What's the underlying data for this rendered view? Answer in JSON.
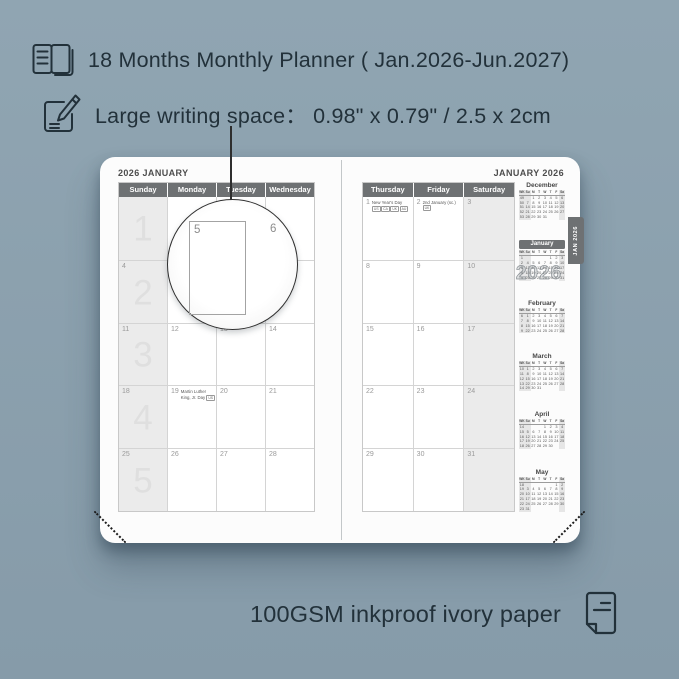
{
  "colors": {
    "background_top": "#90a5b2",
    "background_bottom": "#869ba9",
    "ink_text": "#22313a",
    "header_bar": "#6e7173",
    "page": "#fcfcfc",
    "weekend_shade": "#ebebeb"
  },
  "features": [
    {
      "icon": "open-book-icon",
      "text": "18 Months Monthly Planner ( Jan.2026-Jun.2027)"
    },
    {
      "icon": "pencil-note-icon",
      "text": "Large writing space：  0.98\" x 0.79\" / 2.5 x 2cm"
    }
  ],
  "bottom_feature": {
    "icon": "paper-icon",
    "text": "100GSM inkproof ivory paper"
  },
  "planner": {
    "left_page": {
      "title": "2026 JANUARY",
      "day_headers": [
        "Sunday",
        "Monday",
        "Tuesday",
        "Wednesday"
      ],
      "weekend_column_index": 0,
      "rows": [
        {
          "week": "1",
          "cells": [
            {
              "date": ""
            },
            {
              "date": ""
            },
            {
              "date": ""
            },
            {
              "date": ""
            }
          ]
        },
        {
          "week": "2",
          "cells": [
            {
              "date": "4"
            },
            {
              "date": "5"
            },
            {
              "date": "6"
            },
            {
              "date": "7"
            }
          ]
        },
        {
          "week": "3",
          "cells": [
            {
              "date": "11"
            },
            {
              "date": "12"
            },
            {
              "date": "13"
            },
            {
              "date": "14"
            }
          ]
        },
        {
          "week": "4",
          "cells": [
            {
              "date": "18"
            },
            {
              "date": "19",
              "holiday": "Martin Luther King, Jr. Day",
              "badges": [
                "US"
              ],
              "badges_position": "inline"
            },
            {
              "date": "20"
            },
            {
              "date": "21"
            }
          ]
        },
        {
          "week": "5",
          "cells": [
            {
              "date": "25"
            },
            {
              "date": "26"
            },
            {
              "date": "27"
            },
            {
              "date": "28"
            }
          ]
        }
      ]
    },
    "right_page": {
      "title": "JANUARY 2026",
      "day_headers": [
        "Thursday",
        "Friday",
        "Saturday"
      ],
      "weekend_column_index": 2,
      "rows": [
        {
          "cells": [
            {
              "date": "1",
              "holiday": "New Year's Day",
              "badges": [
                "US",
                "CA",
                "UK",
                "AU"
              ],
              "badges_position": "below"
            },
            {
              "date": "2",
              "holiday": "2nd January (sc.)",
              "badges": [
                "UK"
              ],
              "badges_position": "inline"
            },
            {
              "date": "3"
            }
          ]
        },
        {
          "cells": [
            {
              "date": "8"
            },
            {
              "date": "9"
            },
            {
              "date": "10"
            }
          ]
        },
        {
          "cells": [
            {
              "date": "15"
            },
            {
              "date": "16"
            },
            {
              "date": "17"
            }
          ]
        },
        {
          "cells": [
            {
              "date": "22"
            },
            {
              "date": "23"
            },
            {
              "date": "24"
            }
          ]
        },
        {
          "cells": [
            {
              "date": "29"
            },
            {
              "date": "30"
            },
            {
              "date": "31"
            }
          ]
        }
      ],
      "tab": "JAN 2026",
      "watermark": "2026",
      "mini_header": [
        "WK",
        "Su",
        "M",
        "T",
        "W",
        "T",
        "F",
        "Sa"
      ],
      "mini_calendars": [
        {
          "month": "December",
          "highlight": false,
          "weeks": [
            [
              "49",
              "",
              "1",
              "2",
              "3",
              "4",
              "5",
              "6"
            ],
            [
              "50",
              "7",
              "8",
              "9",
              "10",
              "11",
              "12",
              "13"
            ],
            [
              "51",
              "14",
              "15",
              "16",
              "17",
              "18",
              "19",
              "20"
            ],
            [
              "52",
              "21",
              "22",
              "23",
              "24",
              "25",
              "26",
              "27"
            ],
            [
              "53",
              "28",
              "29",
              "30",
              "31",
              "",
              "",
              ""
            ]
          ]
        },
        {
          "month": "January",
          "highlight": true,
          "weeks": [
            [
              "1",
              "",
              "",
              "",
              "",
              "1",
              "2",
              "3"
            ],
            [
              "2",
              "4",
              "5",
              "6",
              "7",
              "8",
              "9",
              "10"
            ],
            [
              "3",
              "11",
              "12",
              "13",
              "14",
              "15",
              "16",
              "17"
            ],
            [
              "4",
              "18",
              "19",
              "20",
              "21",
              "22",
              "23",
              "24"
            ],
            [
              "5",
              "25",
              "26",
              "27",
              "28",
              "29",
              "30",
              "31"
            ]
          ]
        },
        {
          "month": "February",
          "highlight": false,
          "weeks": [
            [
              "6",
              "1",
              "2",
              "3",
              "4",
              "5",
              "6",
              "7"
            ],
            [
              "7",
              "8",
              "9",
              "10",
              "11",
              "12",
              "13",
              "14"
            ],
            [
              "8",
              "15",
              "16",
              "17",
              "18",
              "19",
              "20",
              "21"
            ],
            [
              "9",
              "22",
              "23",
              "24",
              "25",
              "26",
              "27",
              "28"
            ]
          ]
        },
        {
          "month": "March",
          "highlight": false,
          "weeks": [
            [
              "10",
              "1",
              "2",
              "3",
              "4",
              "5",
              "6",
              "7"
            ],
            [
              "11",
              "8",
              "9",
              "10",
              "11",
              "12",
              "13",
              "14"
            ],
            [
              "12",
              "15",
              "16",
              "17",
              "18",
              "19",
              "20",
              "21"
            ],
            [
              "13",
              "22",
              "23",
              "24",
              "25",
              "26",
              "27",
              "28"
            ],
            [
              "14",
              "29",
              "30",
              "31",
              "",
              "",
              "",
              ""
            ]
          ]
        },
        {
          "month": "April",
          "highlight": false,
          "weeks": [
            [
              "14",
              "",
              "",
              "",
              "1",
              "2",
              "3",
              "4"
            ],
            [
              "15",
              "5",
              "6",
              "7",
              "8",
              "9",
              "10",
              "11"
            ],
            [
              "16",
              "12",
              "13",
              "14",
              "15",
              "16",
              "17",
              "18"
            ],
            [
              "17",
              "19",
              "20",
              "21",
              "22",
              "23",
              "24",
              "25"
            ],
            [
              "18",
              "26",
              "27",
              "28",
              "29",
              "30",
              "",
              ""
            ]
          ]
        },
        {
          "month": "May",
          "highlight": false,
          "weeks": [
            [
              "18",
              "",
              "",
              "",
              "",
              "",
              "1",
              "2"
            ],
            [
              "19",
              "3",
              "4",
              "5",
              "6",
              "7",
              "8",
              "9"
            ],
            [
              "20",
              "10",
              "11",
              "12",
              "13",
              "14",
              "15",
              "16"
            ],
            [
              "21",
              "17",
              "18",
              "19",
              "20",
              "21",
              "22",
              "23"
            ],
            [
              "22",
              "24",
              "25",
              "26",
              "27",
              "28",
              "29",
              "30"
            ],
            [
              "23",
              "31",
              "",
              "",
              "",
              "",
              "",
              ""
            ]
          ]
        }
      ]
    },
    "magnifier": {
      "cell_date": "5",
      "next_cell_date": "6"
    }
  }
}
